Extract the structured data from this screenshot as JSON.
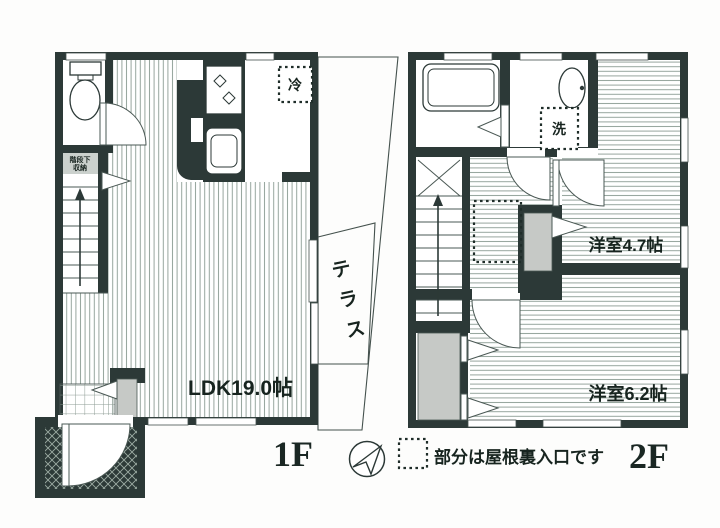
{
  "page": {
    "background": "#ffffff"
  },
  "floor1": {
    "label": "1F",
    "ldk_label": "LDK19.0帖",
    "terrace_chars": [
      "テ",
      "ラ",
      "ス"
    ],
    "stair_storage": {
      "line1": "階段下",
      "line2": "収納"
    },
    "fridge_label": "冷"
  },
  "floor2": {
    "label": "2F",
    "room_small_label": "洋室4.7帖",
    "room_large_label": "洋室6.2帖",
    "washer_label": "洗"
  },
  "legend": {
    "attic_note": "部分は屋根裏入口です"
  },
  "colors": {
    "wall": "#2c3937",
    "hatch_line": "#95a49c",
    "closet_fill": "#c6c9c6",
    "label_text": "#17241f"
  }
}
